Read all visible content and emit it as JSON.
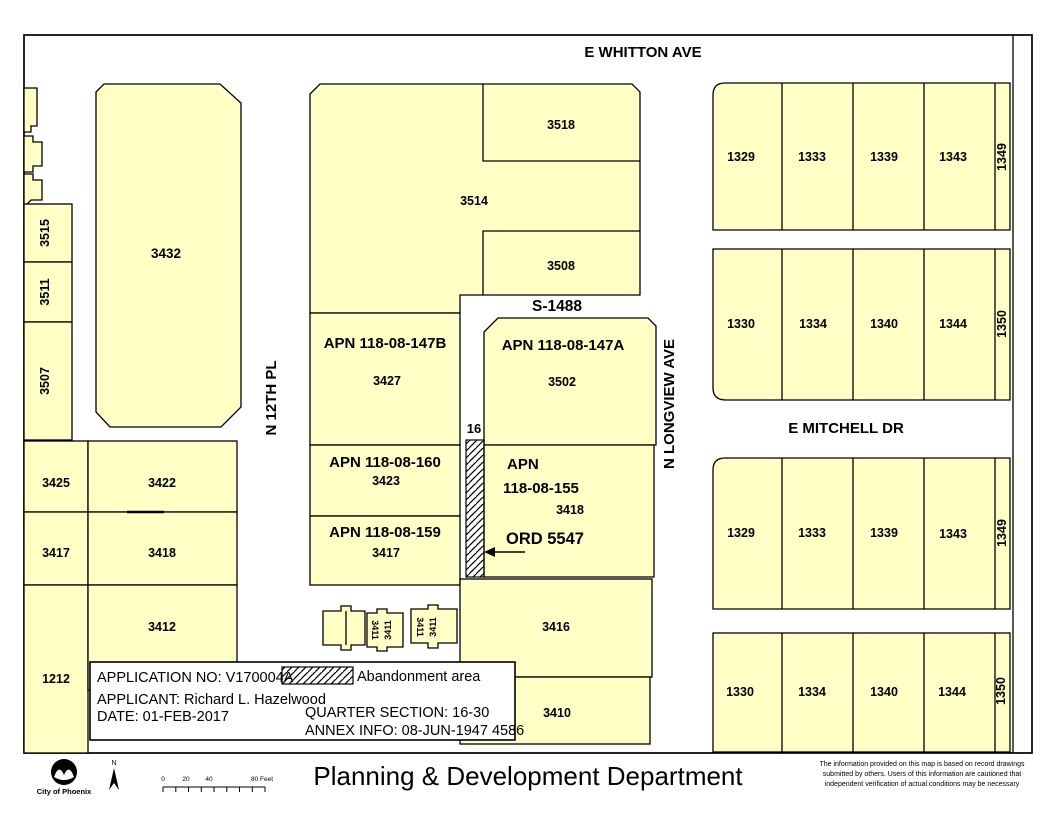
{
  "colors": {
    "parcel_fill": "#FFFFC6",
    "line": "#000000",
    "background": "#FFFFFF"
  },
  "streets": {
    "whitton": "E WHITTON AVE",
    "twelfth_pl": "N 12TH PL",
    "longview": "N LONGVIEW AVE",
    "mitchell": "E MITCHELL DR"
  },
  "annotations": {
    "s1488": "S-1488",
    "gap_width": "16",
    "ord": "ORD 5547"
  },
  "west": {
    "small_rotated": [
      "3515",
      "3511",
      "3507"
    ],
    "large": "3432",
    "grid": {
      "r1c1": "3425",
      "r1c2": "3422",
      "r2c1": "3417",
      "r2c2": "3418",
      "r3c1": "1212",
      "r3c2": "3412"
    }
  },
  "central": {
    "p3518": "3518",
    "p3514": "3514",
    "p3508": "3508",
    "apn147b": "APN 118-08-147B",
    "n3427": "3427",
    "apn147a": "APN 118-08-147A",
    "n3502": "3502",
    "apn160": "APN 118-08-160",
    "n3423": "3423",
    "apn159": "APN 118-08-159",
    "n3417": "3417",
    "apn155_line1": "APN",
    "apn155_line2": "118-08-155",
    "n3418": "3418",
    "p3416": "3416",
    "p3410": "3410",
    "alley_labels": [
      "3411",
      "3411",
      "3411",
      "3411"
    ]
  },
  "east": {
    "row1": [
      "1329",
      "1333",
      "1339",
      "1343",
      "1349"
    ],
    "row2": [
      "1330",
      "1334",
      "1340",
      "1344",
      "1350"
    ],
    "row3": [
      "1329",
      "1333",
      "1339",
      "1343",
      "1349"
    ],
    "row4": [
      "1330",
      "1334",
      "1340",
      "1344",
      "1350"
    ]
  },
  "infobox": {
    "application_no": "APPLICATION NO: V170004A",
    "applicant": "APPLICANT: Richard L. Hazelwood",
    "date": "DATE: 01-FEB-2017",
    "legend_label": "Abandonment area",
    "quarter_section": "QUARTER SECTION: 16-30",
    "annex_info": "ANNEX INFO: 08-JUN-1947 4586"
  },
  "footer": {
    "department": "Planning & Development Department",
    "logo_caption": "City of Phoenix",
    "north": "N",
    "scale_labels": [
      "0",
      "20",
      "40",
      "80 Feet"
    ],
    "disclaimer": [
      "The information provided on this map is based on record drawings",
      "submitted by others. Users of this information are cautioned that",
      "independent verification of actual conditions may be necessary"
    ]
  }
}
